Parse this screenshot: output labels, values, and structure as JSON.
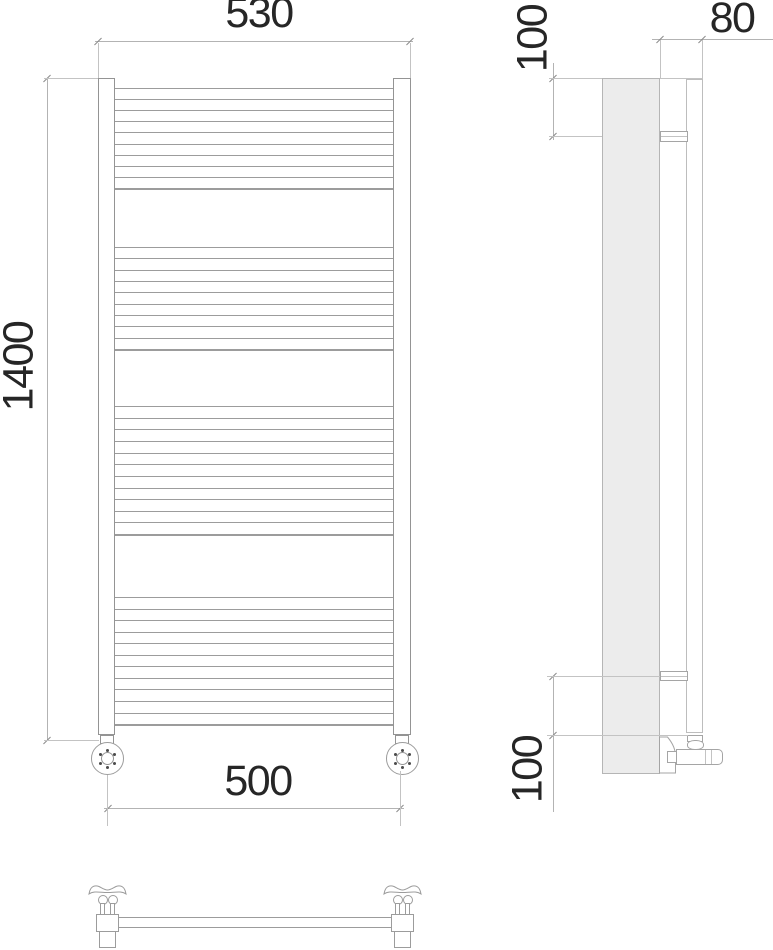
{
  "drawing": {
    "title": "heated towel rail technical drawing",
    "views": {
      "front": "front view",
      "side": "side view",
      "bottom": "bottom view"
    },
    "dimensions": {
      "width_overall": "530",
      "height_overall": "1400",
      "width_axis": "500",
      "depth": "80",
      "offset_top": "100",
      "offset_bottom": "100"
    },
    "front_view": {
      "rung_x1": 115,
      "rung_x2": 393,
      "rung_groups": [
        {
          "y_start": 88,
          "y_end": 188,
          "count": 10
        },
        {
          "y_start": 247,
          "y_end": 349,
          "count": 10
        },
        {
          "y_start": 406,
          "y_end": 534,
          "count": 12
        },
        {
          "y_start": 597,
          "y_end": 724,
          "count": 12
        }
      ]
    },
    "colors": {
      "outline": "#949494",
      "rung": "#9c9c9c",
      "dimension_line": "#b3b3b3",
      "extension_line": "#c3c3c3",
      "tick": "#8a8a8a",
      "panel_fill": "#ececec",
      "text": "#262626",
      "background": "#ffffff"
    }
  }
}
